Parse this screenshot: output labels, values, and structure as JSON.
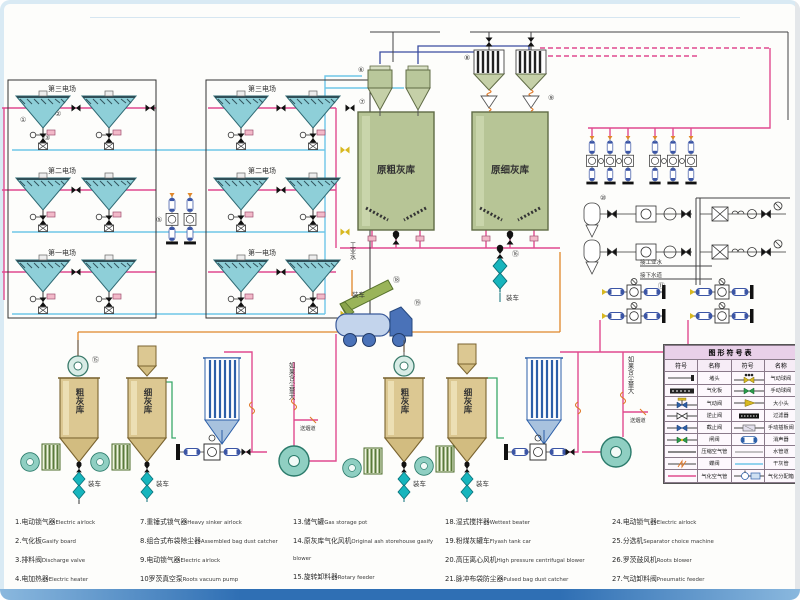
{
  "diagram": {
    "fields": {
      "f3": "第三电场",
      "f2": "第二电场",
      "f1": "第一电场"
    },
    "silos": {
      "raw_coarse": "原粗灰库",
      "raw_fine": "原细灰库",
      "coarse": "粗灰库",
      "fine": "细灰库"
    },
    "labels": {
      "load_truck": "装车",
      "industrial_water": "工业水",
      "connect_industrial_water": "接工业水",
      "connect_sewer": "接下水道",
      "if_dust_large": "如果含尘量大",
      "to_flue": "送烟道"
    },
    "callouts": {
      "n1": "①",
      "n2": "②",
      "n3": "③",
      "n5": "⑤",
      "n6": "⑥",
      "n7": "⑦",
      "n8": "⑧",
      "n9": "⑨",
      "n10": "⑩",
      "n11": "⑪",
      "n15": "⑮",
      "n16": "⑯",
      "n18": "⑱",
      "n19": "⑲"
    },
    "colors": {
      "gasify_air_pipe": "#e04a8f",
      "dry_ash_pipe": "#6ec6e8",
      "compressed_air_pipe": "#444444",
      "vent_pipe": "#3b4da0",
      "water_pipe": "#e0872a",
      "hopper_teal": "#8ecfd8",
      "silo_olive": "#b7c596",
      "silo_tan": "#dcc892"
    }
  },
  "symbol_table": {
    "title": "图形符号表",
    "headers": [
      "符号",
      "名称",
      "符号",
      "名称"
    ],
    "rows": [
      {
        "left": "堵头",
        "right": "气动球阀"
      },
      {
        "left": "气化板",
        "right": "手动球阀"
      },
      {
        "left": "气动阀",
        "right": "大小头"
      },
      {
        "left": "逆止阀",
        "right": "过滤器"
      },
      {
        "left": "截止阀",
        "right": "手动插板阀"
      },
      {
        "left": "闸阀",
        "right": "消声器"
      },
      {
        "left": "压缩空气管",
        "right": "水管道"
      },
      {
        "left": "蝶阀",
        "right": "干灰管"
      },
      {
        "left": "气化空气管",
        "right": "气化分配箱"
      }
    ]
  },
  "equipment_list": {
    "columns": [
      [
        {
          "n": "1.",
          "zh": "电动锁气器",
          "en": "Electric airlock"
        },
        {
          "n": "2.",
          "zh": "气化板",
          "en": "Gasify board"
        },
        {
          "n": "3.",
          "zh": "排料阀",
          "en": "Discharge valve"
        },
        {
          "n": "4.",
          "zh": "电加热器",
          "en": "Electric heater"
        },
        {
          "n": "5.",
          "zh": "灰斗气化风机",
          "en": "Ash gasify blower"
        },
        {
          "n": "6.",
          "zh": "旋风分离器",
          "en": "Cyclone separator"
        }
      ],
      [
        {
          "n": "7.",
          "zh": "重锤式锁气器",
          "en": "Heavy sinker airlock"
        },
        {
          "n": "8.",
          "zh": "组合式布袋除尘器",
          "en": "Assembled bag dust catcher"
        },
        {
          "n": "9.",
          "zh": "电动锁气器",
          "en": "Electric airlock"
        },
        {
          "n": "10",
          "zh": "罗茨真空泵",
          "en": "Roots vacuum pump"
        },
        {
          "n": "11.",
          "zh": "螺杆空气压缩机",
          "en": "Screw air compressor"
        },
        {
          "n": "12.",
          "zh": "冷冻干燥器",
          "en": "Freeze dryer"
        }
      ],
      [
        {
          "n": "13.",
          "zh": "储气罐",
          "en": "Gas storage pot"
        },
        {
          "n": "14.",
          "zh": "原灰库气化风机",
          "en": "Original ash storehouse gasify blower"
        },
        {
          "n": "15.",
          "zh": "旋转卸料器",
          "en": "Rotary feeder"
        },
        {
          "n": "16.",
          "zh": "干灰散装机",
          "en": "Dry ash bulk machine"
        },
        {
          "n": "17.",
          "zh": "电加热器",
          "en": "Electric heater"
        }
      ],
      [
        {
          "n": "18.",
          "zh": "湿式搅拌器",
          "en": "Wettest beater"
        },
        {
          "n": "19.",
          "zh": "粉煤灰罐车",
          "en": "Flyash tank car"
        },
        {
          "n": "20.",
          "zh": "高压离心风机",
          "en": "High pressure centrifugal blower"
        },
        {
          "n": "21.",
          "zh": "脉冲布袋防尘器",
          "en": "Pulsed bag dust catcher"
        },
        {
          "n": "22.",
          "zh": "旋转供料器",
          "en": "Rotary feeder"
        },
        {
          "n": "23",
          "zh": "多管收集器",
          "en": "Multi pipe collector"
        }
      ],
      [
        {
          "n": "24.",
          "zh": "电动锁气器",
          "en": "Electric airlock"
        },
        {
          "n": "25.",
          "zh": "分选机",
          "en": "Separator choice machine"
        },
        {
          "n": "26.",
          "zh": "罗茨鼓风机",
          "en": "Roots blower"
        },
        {
          "n": "27.",
          "zh": "气动卸料阀",
          "en": "Pneumatic feeder"
        },
        {
          "n": "28.",
          "zh": "袋式过滤器",
          "en": "Bag filter"
        },
        {
          "n": "29.",
          "zh": "引风机",
          "en": "Suction blower"
        }
      ]
    ]
  }
}
